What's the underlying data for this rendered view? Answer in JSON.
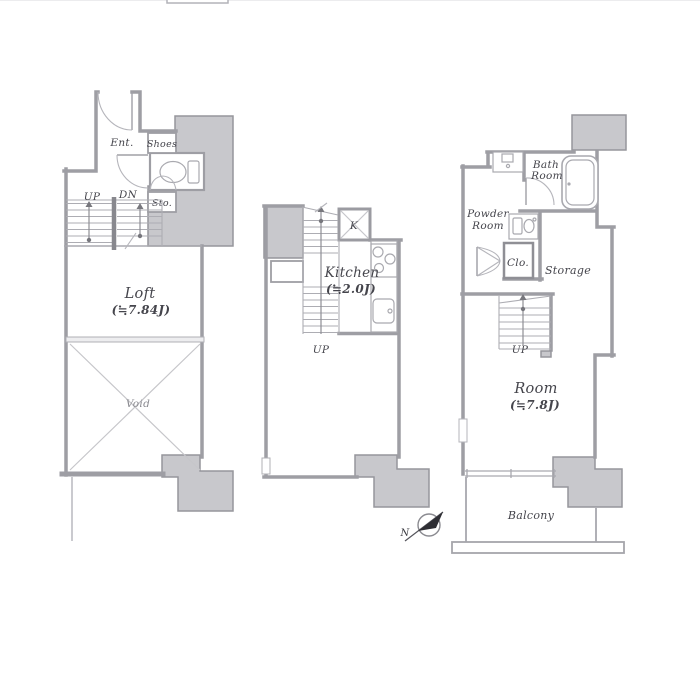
{
  "title": "floor-plan",
  "colors": {
    "wall": "#9e9ea4",
    "pillar_fill": "#c8c8cc",
    "text": "#45454c",
    "background": "#ffffff",
    "compass_fill": "#2e2e34"
  },
  "plan_left": {
    "ent": "Ent.",
    "shoes": "Shoes",
    "sto": "Sto.",
    "up": "UP",
    "dn": "DN",
    "loft_name": "Loft",
    "loft_size": "(≒7.84J)",
    "void": "Void"
  },
  "plan_middle": {
    "shaft": "K",
    "kitchen_name": "Kitchen",
    "kitchen_size": "(≒2.0J)",
    "up": "UP"
  },
  "plan_right": {
    "bath_line1": "Bath",
    "bath_line2": "Room",
    "powder_line1": "Powder",
    "powder_line2": "Room",
    "closet": "Clo.",
    "storage": "Storage",
    "up": "UP",
    "room_name": "Room",
    "room_size": "(≒7.8J)",
    "balcony": "Balcony"
  },
  "compass": {
    "north": "N"
  }
}
